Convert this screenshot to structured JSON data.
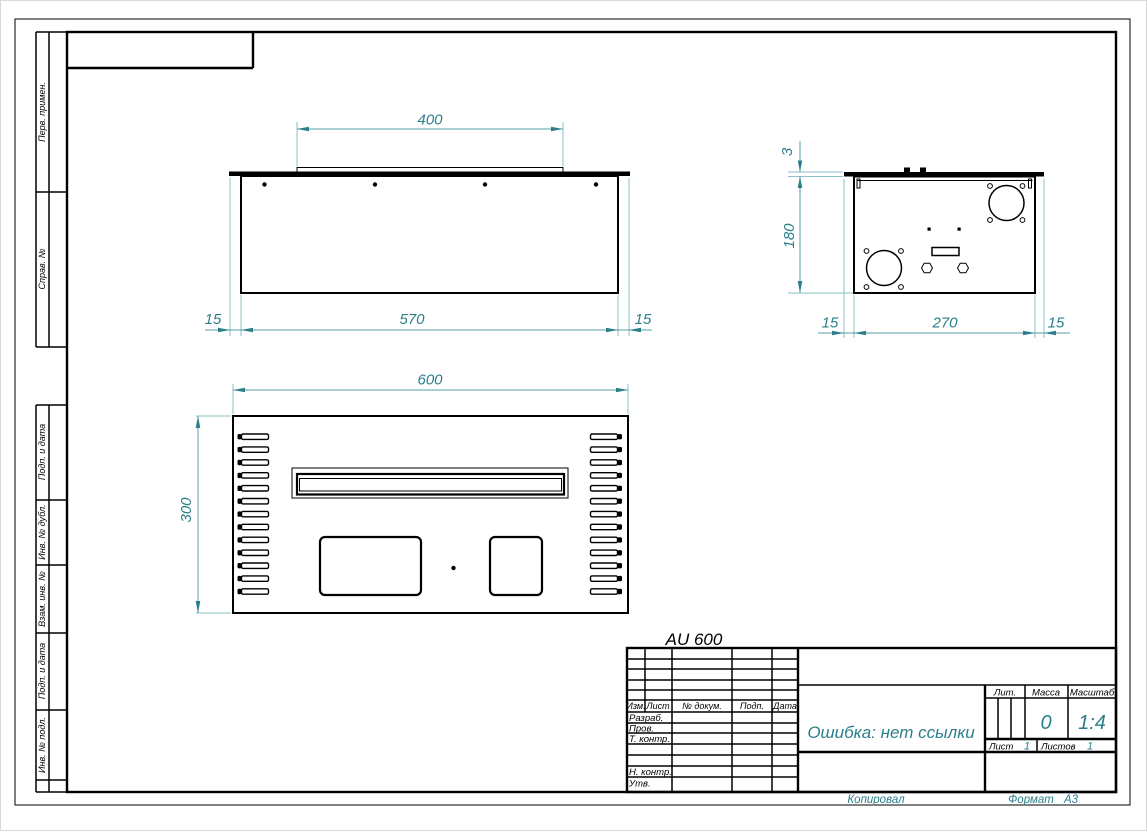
{
  "header": {
    "title": "AU 600"
  },
  "margin": {
    "labels": [
      "Перв. примен.",
      "Справ. №",
      "Подп. и дата",
      "Инв. № дубл.",
      "Взам. инв. №",
      "Подп. и дата",
      "Инв. № подл."
    ]
  },
  "views": {
    "front": {
      "dims": {
        "top": "400",
        "bottom": "570",
        "left": "15",
        "right": "15"
      }
    },
    "side": {
      "dims": {
        "thickness": "3",
        "height": "180",
        "left": "15",
        "width": "270",
        "right": "15"
      }
    },
    "top": {
      "dims": {
        "width": "600",
        "height": "300"
      },
      "vent_slot_rows": 13
    }
  },
  "tb": {
    "cols": {
      "izm": "Изм.",
      "list": "Лист",
      "dok": "№ докум.",
      "podp": "Подп.",
      "data": "Дата"
    },
    "rows": {
      "razrab": "Разраб.",
      "prov": "Пров.",
      "tkontr": "Т. контр.",
      "nkontr": "Н. контр.",
      "utv": "Утв."
    },
    "name": "Ошибка: нет ссылки",
    "lit": "Лит.",
    "massa": "Масса",
    "massa_value": "0",
    "masshtab": "Масштаб",
    "masshtab_value": "1:4",
    "list_label": "Лист",
    "list_value": "1",
    "listov_label": "Листов",
    "listov_value": "1"
  },
  "footer": {
    "kopiroval": "Копировал",
    "format_label": "Формат",
    "format_value": "A3"
  },
  "colors": {
    "dimension": "#2b7f8a",
    "line": "#000000"
  }
}
